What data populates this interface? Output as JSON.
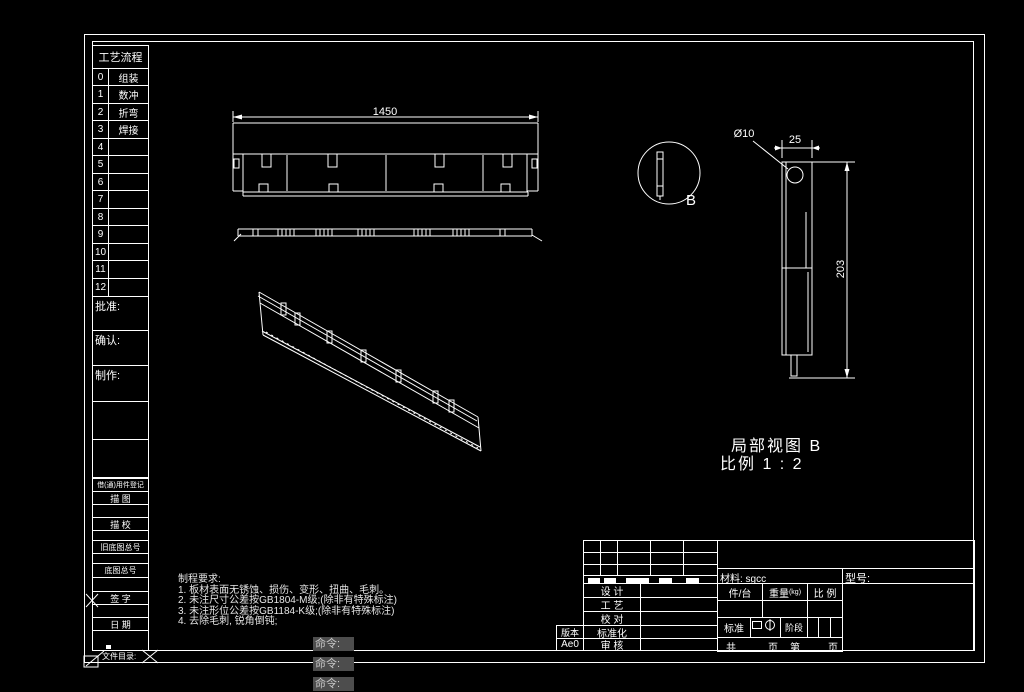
{
  "colors": {
    "canvas_bg": "#000000",
    "line_color": "#ffffff",
    "command_text": "#c9c9c9",
    "command_bg": "#4d4d4d"
  },
  "process_table": {
    "title": "工艺流程",
    "rows": [
      {
        "num": "0",
        "label": "组装"
      },
      {
        "num": "1",
        "label": "数冲"
      },
      {
        "num": "2",
        "label": "折弯"
      },
      {
        "num": "3",
        "label": "焊接"
      },
      {
        "num": "4",
        "label": ""
      },
      {
        "num": "5",
        "label": ""
      },
      {
        "num": "6",
        "label": ""
      },
      {
        "num": "7",
        "label": ""
      },
      {
        "num": "8",
        "label": ""
      },
      {
        "num": "9",
        "label": ""
      },
      {
        "num": "10",
        "label": ""
      },
      {
        "num": "11",
        "label": ""
      },
      {
        "num": "12",
        "label": ""
      }
    ]
  },
  "left_panel": {
    "approve": "批准:",
    "confirm": "确认:",
    "make": "制作:",
    "register": "借(通)用件登记",
    "trace": "描 图",
    "trace_check": "描 校",
    "old_drawing_no": "旧底图总号",
    "drawing_no": "底图总号",
    "sign": "签 字",
    "date": "日 期",
    "file_dir": "文件目录:"
  },
  "notes": {
    "title": "制程要求:",
    "lines": [
      "1. 板材表面无锈蚀、损伤、变形、扭曲、毛刺。",
      "2. 未注尺寸公差按GB1804-M级;(除非有特殊标注)",
      "3. 未注形位公差按GB1184-K级;(除非有特殊标注)",
      "4. 去除毛刺, 锐角倒钝;"
    ]
  },
  "title_block": {
    "material": "材料: sgcc",
    "model": "型号:",
    "pcs_per_unit": "件/台",
    "weight": "重量",
    "weight_unit": "(kg)",
    "scale": "比 例",
    "rows": {
      "design": "设 计",
      "process": "工 艺",
      "proof": "校 对",
      "standardize": "标准化",
      "audit": "审 核"
    },
    "standard": "标准",
    "stage": "阶段",
    "pages": {
      "total": "共",
      "page": "页",
      "no": "第",
      "page2": "页"
    },
    "version_label": "版本",
    "version_value": "Ae0"
  },
  "views": {
    "front_dim": "1450",
    "detail_dia": "Ø10",
    "detail_width": "25",
    "detail_height": "203",
    "detail_mark": "B",
    "caption_line1": "局部视图 B",
    "caption_line2": "比例 1 : 2"
  },
  "command_line": {
    "history": [
      "命令:",
      "命令:",
      "命令:"
    ]
  }
}
